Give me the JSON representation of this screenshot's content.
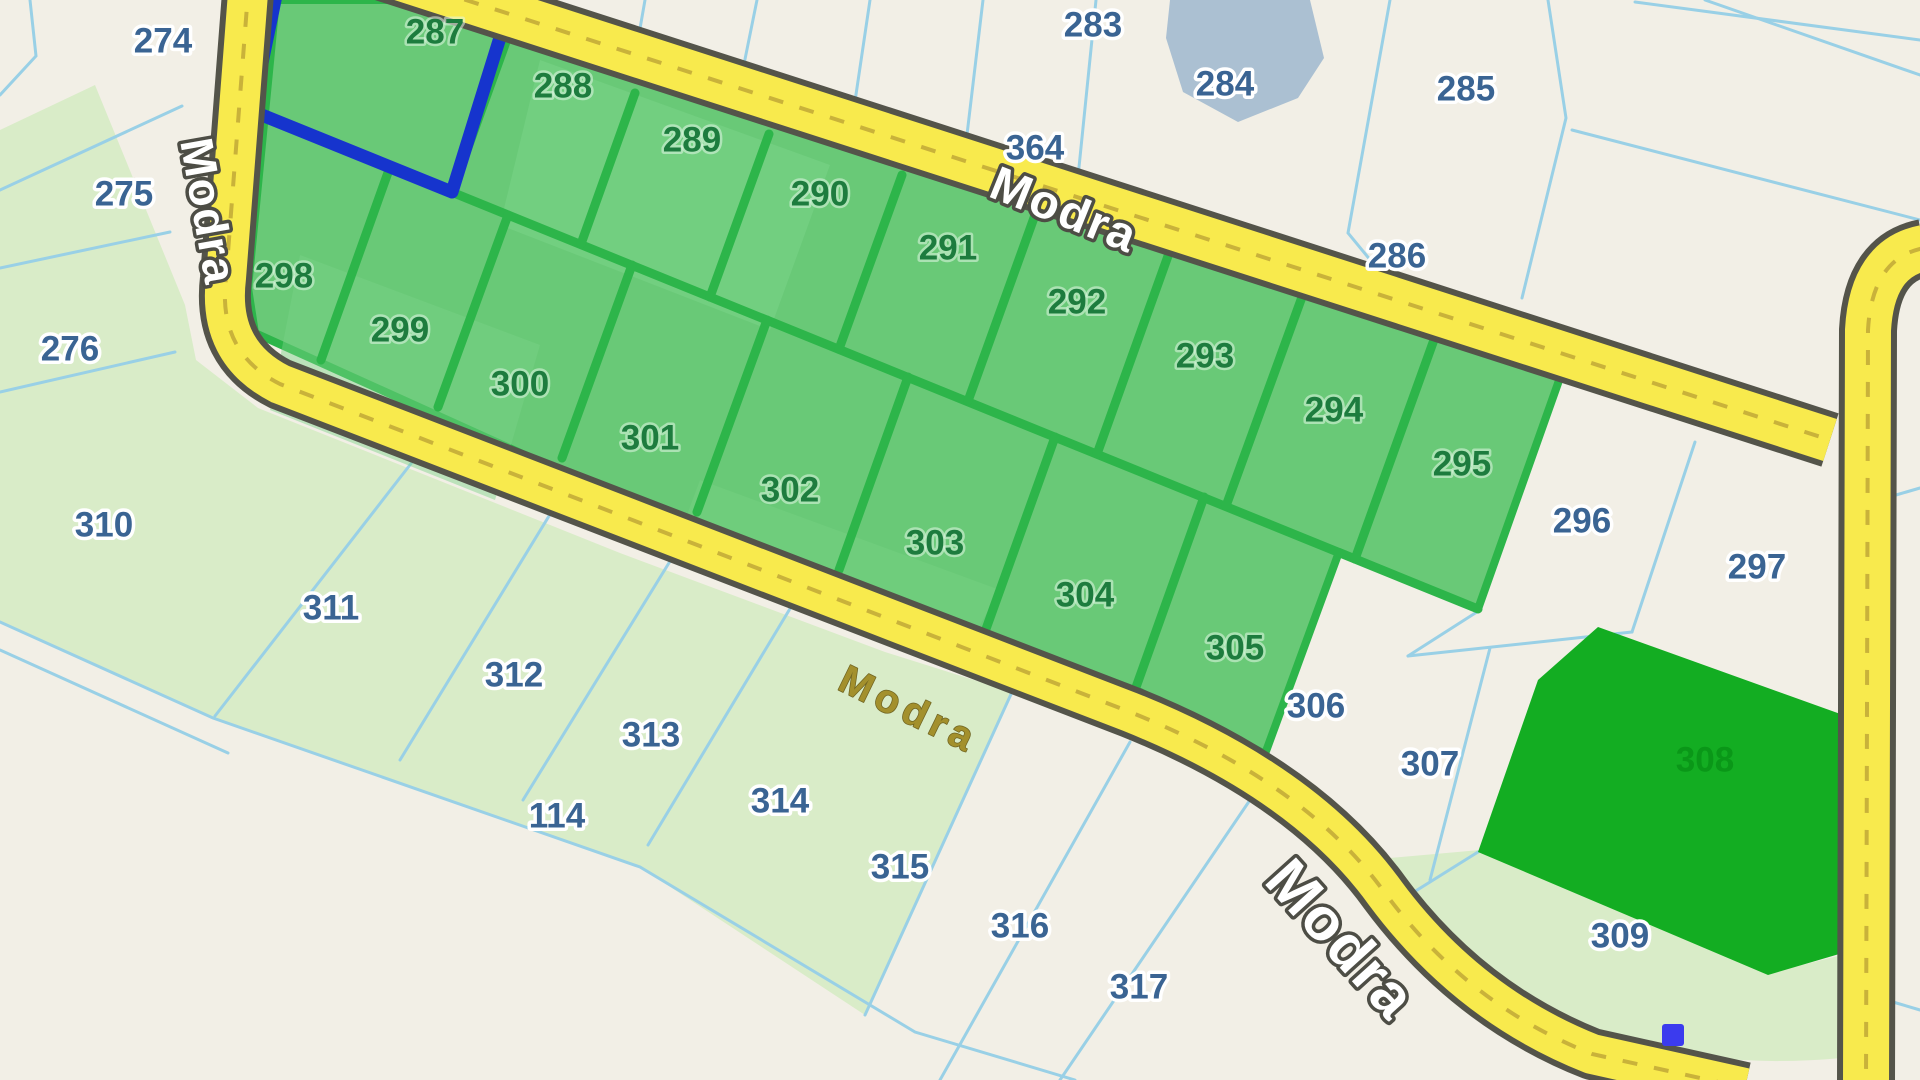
{
  "map": {
    "road_name": "Modra",
    "colors": {
      "bg_cream": "#f2efe6",
      "light_green": "#d9ecc8",
      "block_green_fill": "#69c977",
      "block_light_patch": "#7ad388",
      "block_border_green": "#2db54a",
      "solid_parcel_green": "#13ad22",
      "solid_label_green": "#0a9718",
      "selected_outline_blue": "#1634cd",
      "boundary_blue": "#99d0e6",
      "label_blue": "#3a6493",
      "label_green": "#1d7c3e",
      "road_yellow": "#f8ea4d",
      "road_casing": "#54544a",
      "road_dash": "#c9b23a",
      "road_label_olive": "#a3902c",
      "road_label_outline": "#4d4d45",
      "pond_blue": "#abc0d2",
      "marker_blue": "#3b3bee"
    },
    "parcel_labels": [
      {
        "number": "274",
        "x": 163,
        "y": 43,
        "kind": "plain"
      },
      {
        "number": "275",
        "x": 124,
        "y": 196,
        "kind": "plain"
      },
      {
        "number": "276",
        "x": 70,
        "y": 351,
        "kind": "plain"
      },
      {
        "number": "283",
        "x": 1093,
        "y": 27,
        "kind": "plain"
      },
      {
        "number": "284",
        "x": 1225,
        "y": 86,
        "kind": "plain"
      },
      {
        "number": "285",
        "x": 1466,
        "y": 91,
        "kind": "plain"
      },
      {
        "number": "286",
        "x": 1397,
        "y": 258,
        "kind": "plain"
      },
      {
        "number": "364",
        "x": 1035,
        "y": 150,
        "kind": "plain",
        "size": 31
      },
      {
        "number": "296",
        "x": 1582,
        "y": 523,
        "kind": "plain"
      },
      {
        "number": "297",
        "x": 1757,
        "y": 569,
        "kind": "plain"
      },
      {
        "number": "306",
        "x": 1316,
        "y": 708,
        "kind": "plain"
      },
      {
        "number": "307",
        "x": 1430,
        "y": 766,
        "kind": "plain"
      },
      {
        "number": "309",
        "x": 1620,
        "y": 938,
        "kind": "plain"
      },
      {
        "number": "310",
        "x": 104,
        "y": 527,
        "kind": "plain"
      },
      {
        "number": "311",
        "x": 331,
        "y": 610,
        "kind": "plain"
      },
      {
        "number": "312",
        "x": 514,
        "y": 677,
        "kind": "plain"
      },
      {
        "number": "313",
        "x": 651,
        "y": 737,
        "kind": "plain"
      },
      {
        "number": "114",
        "x": 557,
        "y": 818,
        "kind": "plain"
      },
      {
        "number": "314",
        "x": 780,
        "y": 803,
        "kind": "plain"
      },
      {
        "number": "315",
        "x": 900,
        "y": 869,
        "kind": "plain"
      },
      {
        "number": "316",
        "x": 1020,
        "y": 928,
        "kind": "plain"
      },
      {
        "number": "317",
        "x": 1139,
        "y": 989,
        "kind": "plain"
      },
      {
        "number": "287",
        "x": 435,
        "y": 34,
        "kind": "selected"
      },
      {
        "number": "288",
        "x": 563,
        "y": 88,
        "kind": "selected"
      },
      {
        "number": "289",
        "x": 692,
        "y": 142,
        "kind": "selected"
      },
      {
        "number": "290",
        "x": 820,
        "y": 196,
        "kind": "selected"
      },
      {
        "number": "291",
        "x": 948,
        "y": 250,
        "kind": "selected"
      },
      {
        "number": "292",
        "x": 1077,
        "y": 304,
        "kind": "selected"
      },
      {
        "number": "293",
        "x": 1205,
        "y": 358,
        "kind": "selected"
      },
      {
        "number": "294",
        "x": 1334,
        "y": 412,
        "kind": "selected"
      },
      {
        "number": "295",
        "x": 1462,
        "y": 466,
        "kind": "selected"
      },
      {
        "number": "298",
        "x": 284,
        "y": 278,
        "kind": "selected"
      },
      {
        "number": "299",
        "x": 400,
        "y": 332,
        "kind": "selected"
      },
      {
        "number": "300",
        "x": 520,
        "y": 386,
        "kind": "selected"
      },
      {
        "number": "301",
        "x": 650,
        "y": 440,
        "kind": "selected"
      },
      {
        "number": "302",
        "x": 790,
        "y": 492,
        "kind": "selected"
      },
      {
        "number": "303",
        "x": 935,
        "y": 545,
        "kind": "selected"
      },
      {
        "number": "304",
        "x": 1085,
        "y": 597,
        "kind": "selected"
      },
      {
        "number": "305",
        "x": 1235,
        "y": 650,
        "kind": "selected"
      },
      {
        "number": "308",
        "x": 1705,
        "y": 762,
        "kind": "solid",
        "size": 38
      }
    ],
    "road_labels": [
      {
        "text": "Modra",
        "x": 205,
        "y": 212,
        "rotate": 80,
        "style": "outlined",
        "size": 46
      },
      {
        "text": "Modra",
        "x": 1063,
        "y": 213,
        "rotate": 22,
        "style": "outlined",
        "size": 48
      },
      {
        "text": "Modra",
        "x": 908,
        "y": 712,
        "rotate": 26,
        "style": "olive",
        "size": 40
      },
      {
        "text": "Modra",
        "x": 1338,
        "y": 942,
        "rotate": 48,
        "style": "outlined",
        "size": 60
      }
    ],
    "marker": {
      "x": 1673,
      "y": 1035
    }
  }
}
